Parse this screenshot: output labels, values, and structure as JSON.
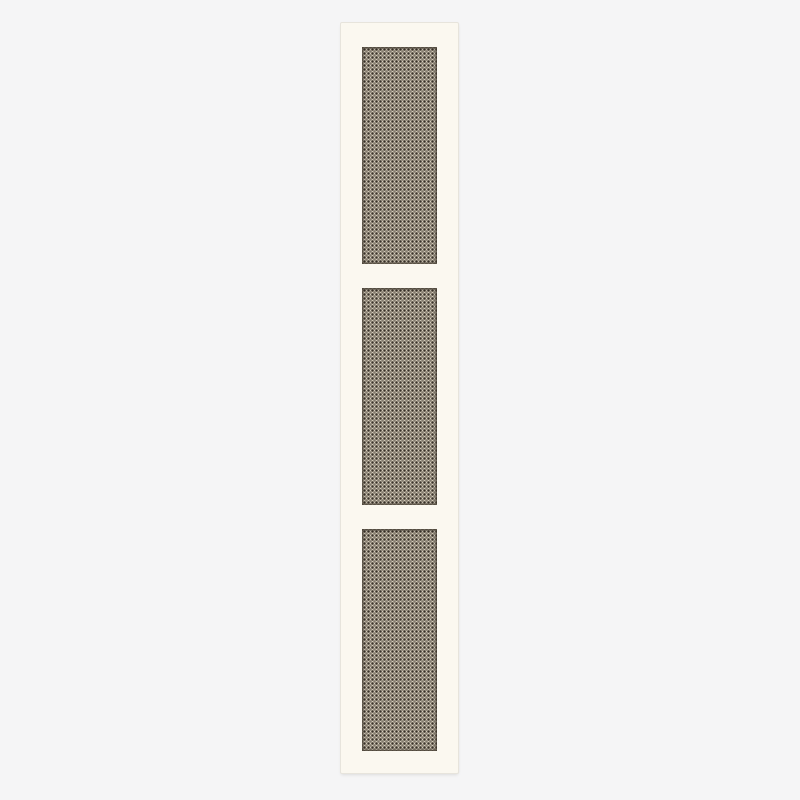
{
  "meta": {
    "type": "product-image",
    "subject": "Tall cabinet door with three cane webbing panels"
  },
  "colors": {
    "page_background": "#f5f5f6",
    "door_surface": "#fbf8f0",
    "door_edge": "#e7e4dc",
    "door_shadow": "rgba(0,0,0,0.10)",
    "cane_strand": "#cec5b1",
    "cane_hole": "#39322a",
    "panel_recess_shadow": "rgba(77,70,58,0.5)"
  },
  "door": {
    "panel_count": 3,
    "panels": [
      {
        "id": "cane-panel-top"
      },
      {
        "id": "cane-panel-middle"
      },
      {
        "id": "cane-panel-bottom"
      }
    ]
  }
}
